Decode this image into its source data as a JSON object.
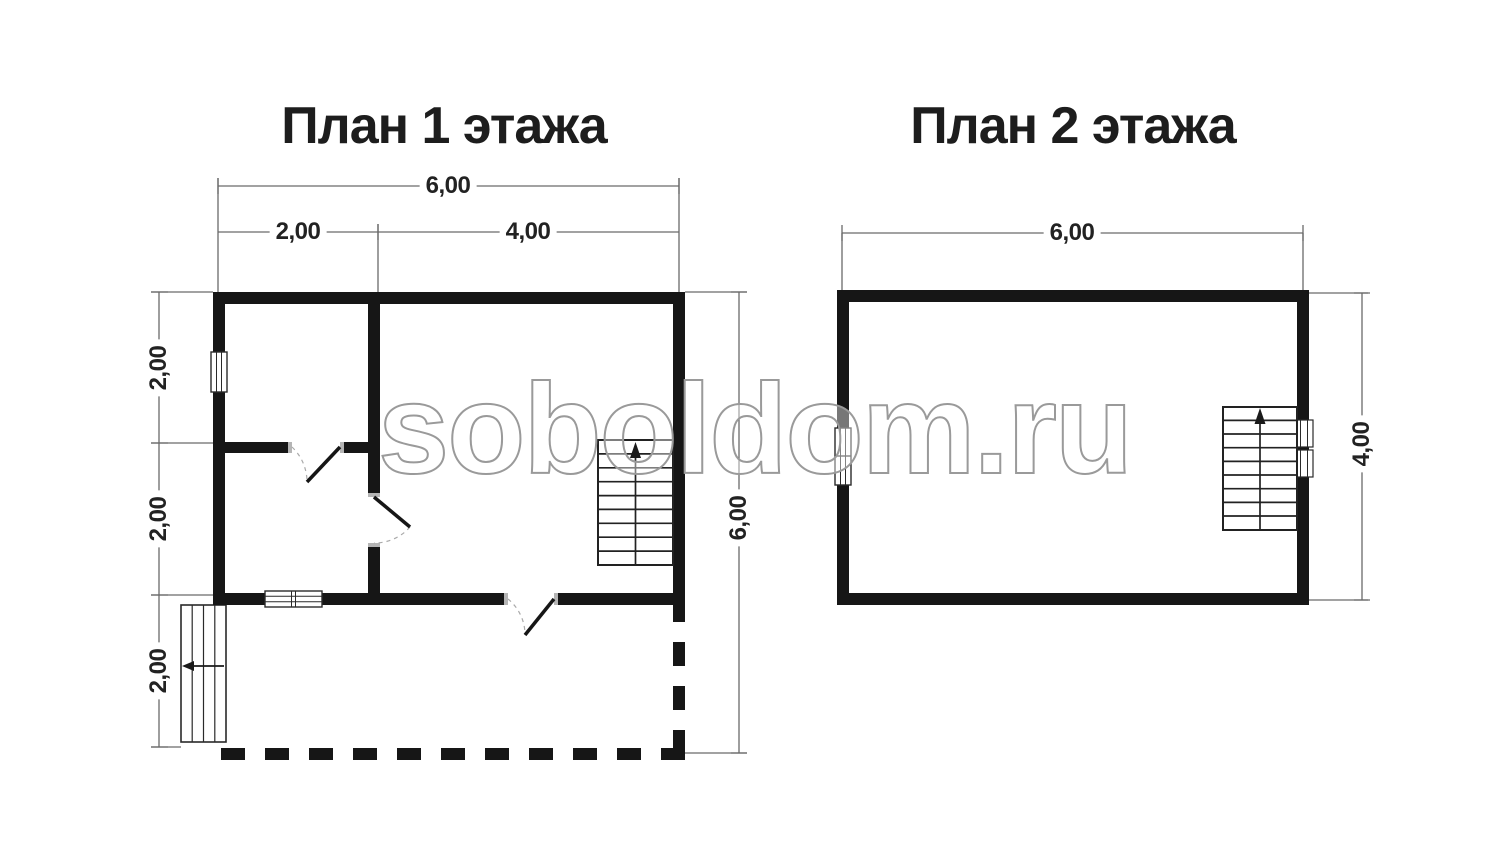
{
  "watermark": {
    "text": "soboldom.ru",
    "stroke_color": "#9a9a9a"
  },
  "plan1": {
    "title": "План 1 этажа",
    "dimensions": {
      "top_total": "6,00",
      "top_segments": [
        "2,00",
        "4,00"
      ],
      "left_segments": [
        "2,00",
        "2,00",
        "2,00"
      ],
      "right_total": "6,00"
    }
  },
  "plan2": {
    "title": "План 2 этажа",
    "dimensions": {
      "top_total": "6,00",
      "right_total": "4,00"
    }
  },
  "colors": {
    "background": "#ffffff",
    "wall": "#161616",
    "detail_line": "#2a2a2a",
    "dimension_line": "#6a6a6a",
    "door_jamb": "#b5b5b5",
    "door_swing_arc": "#aaaaaa",
    "watermark_stroke": "#9a9a9a",
    "text": "#1d1d1d"
  }
}
